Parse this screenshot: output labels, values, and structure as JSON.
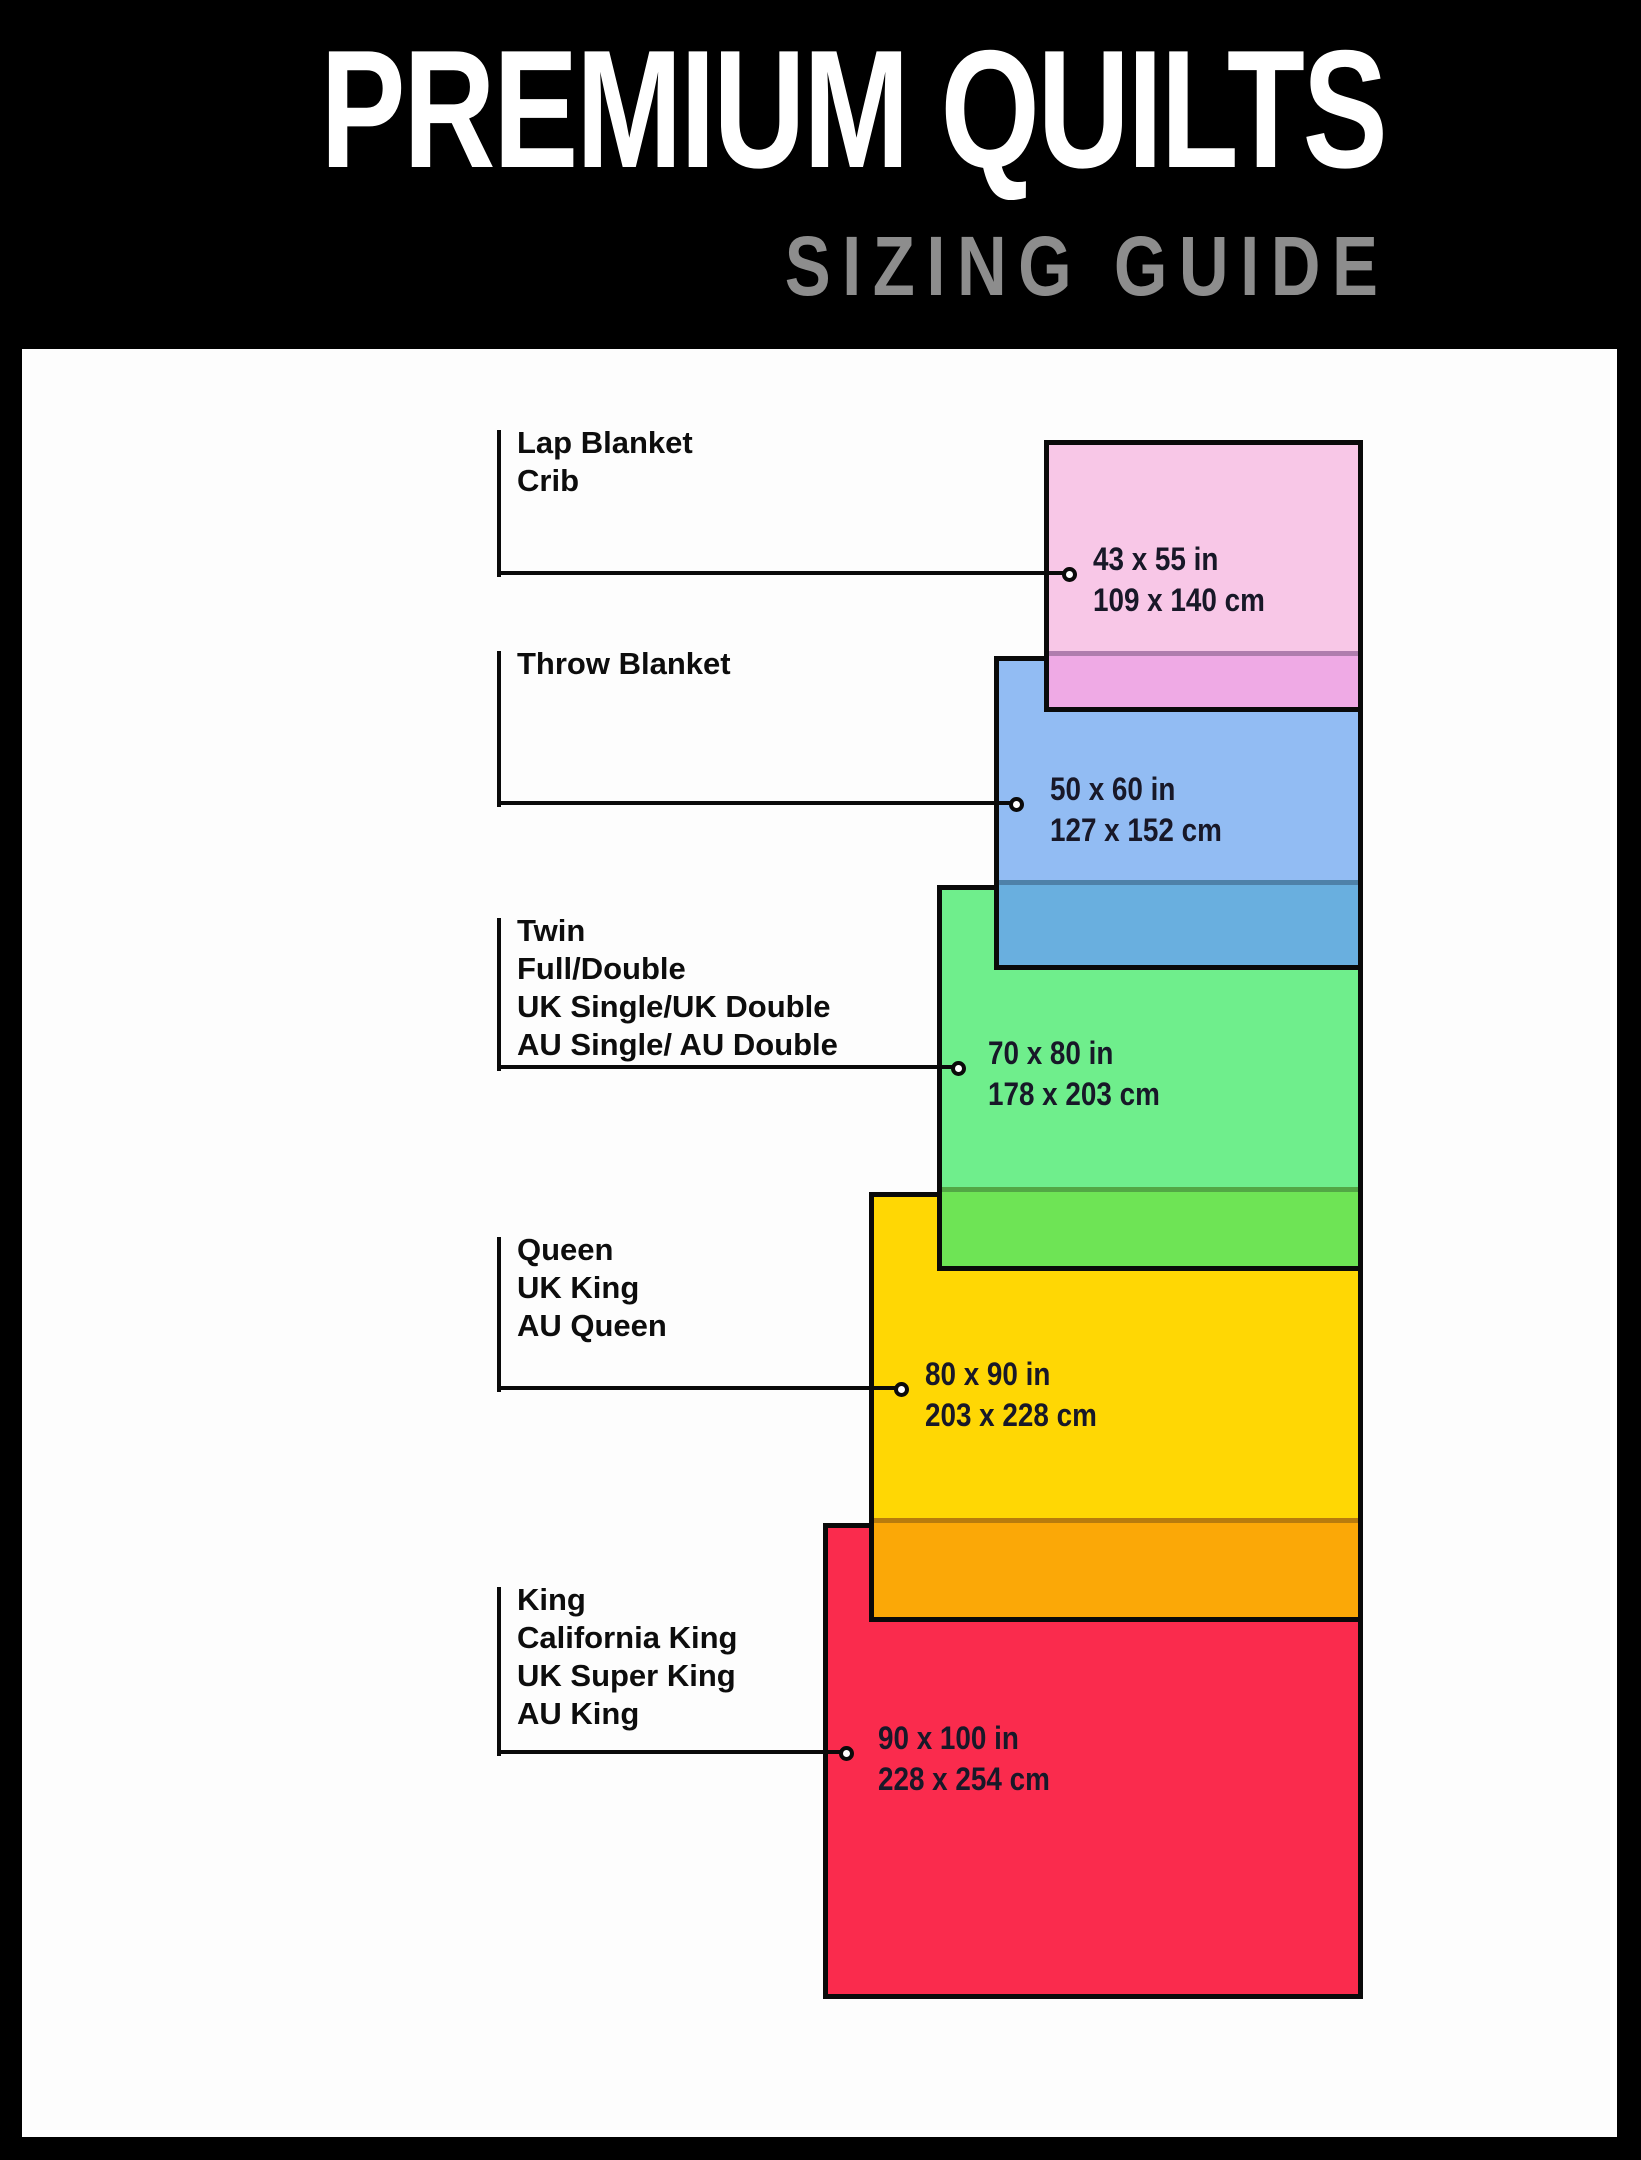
{
  "header": {
    "title": "PREMIUM QUILTS",
    "subtitle": "SIZING GUIDE"
  },
  "colors": {
    "page-bg": "#000000",
    "panel-bg": "#fdfdfd",
    "title-color": "#ffffff",
    "subtitle-color": "#8d8d8d",
    "label-ink": "#0d0d0d",
    "dim-ink": "#181828",
    "line-ink": "#0a0a0a"
  },
  "sizes": [
    {
      "labels": [
        "Lap Blanket",
        "Crib"
      ],
      "inches": "43 x 55 in",
      "cm": "109 x 140 cm",
      "fill": "#f8c7e7",
      "overlap_fill": "#efaae5",
      "geom": {
        "rect": [
          1044,
          440,
          319,
          272
        ],
        "overlap_h": 56,
        "line_y": 573,
        "circle_x": 1069,
        "text_x": 1093,
        "label_top": 424
      }
    },
    {
      "labels": [
        "Throw Blanket"
      ],
      "inches": "50 x 60 in",
      "cm": "127 x 152 cm",
      "fill": "#92bcf3",
      "overlap_fill": "#69afdf",
      "geom": {
        "rect": [
          994,
          656,
          369,
          314
        ],
        "overlap_h": 85,
        "line_y": 803,
        "circle_x": 1016,
        "text_x": 1050,
        "label_top": 645
      }
    },
    {
      "labels": [
        "Twin",
        "Full/Double",
        "UK Single/UK Double",
        "AU Single/ AU Double"
      ],
      "inches": "70 x 80 in",
      "cm": "178 x 203 cm",
      "fill": "#6fee8c",
      "overlap_fill": "#6ee455",
      "geom": {
        "rect": [
          937,
          885,
          426,
          386
        ],
        "overlap_h": 79,
        "line_y": 1067,
        "circle_x": 958,
        "text_x": 988,
        "label_top": 912
      }
    },
    {
      "labels": [
        "Queen",
        "UK King",
        "AU Queen"
      ],
      "inches": "80 x 90 in",
      "cm": "203 x 228 cm",
      "fill": "#ffd704",
      "overlap_fill": "#fba807",
      "geom": {
        "rect": [
          869,
          1192,
          494,
          430
        ],
        "overlap_h": 99,
        "line_y": 1388,
        "circle_x": 901,
        "text_x": 925,
        "label_top": 1231
      }
    },
    {
      "labels": [
        "King",
        "California King",
        "UK Super King",
        "AU King"
      ],
      "inches": "90 x 100 in",
      "cm": "228 x 254 cm",
      "fill": "#fa2b4d",
      "overlap_fill": "#fa2b4d",
      "geom": {
        "rect": [
          823,
          1523,
          540,
          476
        ],
        "overlap_h": 0,
        "line_y": 1752,
        "circle_x": 846,
        "text_x": 878,
        "label_top": 1581
      }
    }
  ]
}
